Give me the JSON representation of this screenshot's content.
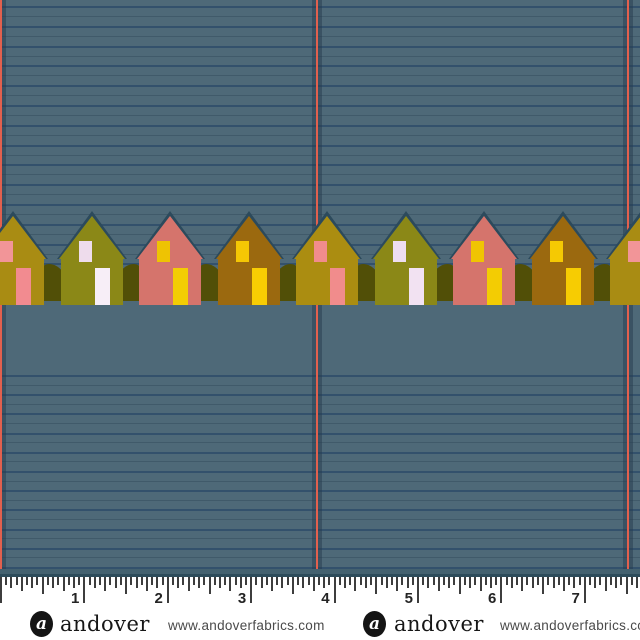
{
  "fabric": {
    "background": "#4e6978",
    "rule_line_color": "#33516c",
    "faint_line_color": "rgba(34,56,76,0.30)",
    "top_lines": {
      "start": 6,
      "spacing": 19.8,
      "count": 15
    },
    "bottom_lines": {
      "start": 375,
      "spacing": 19.2,
      "count": 11
    },
    "vertical_lines": {
      "color": "#e2604e",
      "shadow_color": "rgba(38,60,78,0.50)",
      "positions": [
        0,
        316,
        627
      ]
    },
    "edge_band_color": "#44616f",
    "edge_line_color": "#2d4b5a"
  },
  "houses": {
    "roof_outline_color": "#2c4a5c",
    "bush_color": "#514f07",
    "peaks": [
      13,
      91.5,
      170,
      248.5,
      327,
      405.5,
      484,
      562.5,
      641
    ],
    "list": [
      {
        "name": "mustard-house-pink-door",
        "body": "#a98c13",
        "window": "#f29598",
        "door": "#f28b90"
      },
      {
        "name": "olive-house-white-door",
        "body": "#8b8817",
        "window": "#eedcec",
        "door": "#f7eef7"
      },
      {
        "name": "coral-house-yellow-door",
        "body": "#d5746c",
        "window": "#eec303",
        "door": "#f3cd04"
      },
      {
        "name": "brown-house-yellow-door",
        "body": "#9b690f",
        "window": "#f5c704",
        "door": "#f8cd03"
      },
      {
        "name": "mustard-house-pink-door",
        "body": "#ab8d11",
        "window": "#f18c8c",
        "door": "#f18c8c"
      },
      {
        "name": "olive-house-lavender-door",
        "body": "#8b8817",
        "window": "#eeddf0",
        "door": "#f2e2f2"
      },
      {
        "name": "coral-house-yellow-door",
        "body": "#d5746c",
        "window": "#f0c402",
        "door": "#f3cc03"
      },
      {
        "name": "brown-house-yellow-door",
        "body": "#9b690f",
        "window": "#f5c903",
        "door": "#f7cc02"
      },
      {
        "name": "mustard-house-pink-door",
        "body": "#a98c13",
        "window": "#f29598",
        "door": "#f28b90"
      }
    ]
  },
  "ruler": {
    "tick_color": "#3d3d3d",
    "inch_px": 83.4,
    "numbers": [
      "1",
      "2",
      "3",
      "4",
      "5",
      "6",
      "7"
    ]
  },
  "branding": {
    "logo_letter": "a",
    "name": "andover",
    "url": "www.andoverfabrics.com",
    "instances": [
      {
        "logo_x": 30,
        "name_x": 60,
        "url_x": 168
      },
      {
        "logo_x": 363,
        "name_x": 394,
        "url_x": 500
      }
    ]
  }
}
